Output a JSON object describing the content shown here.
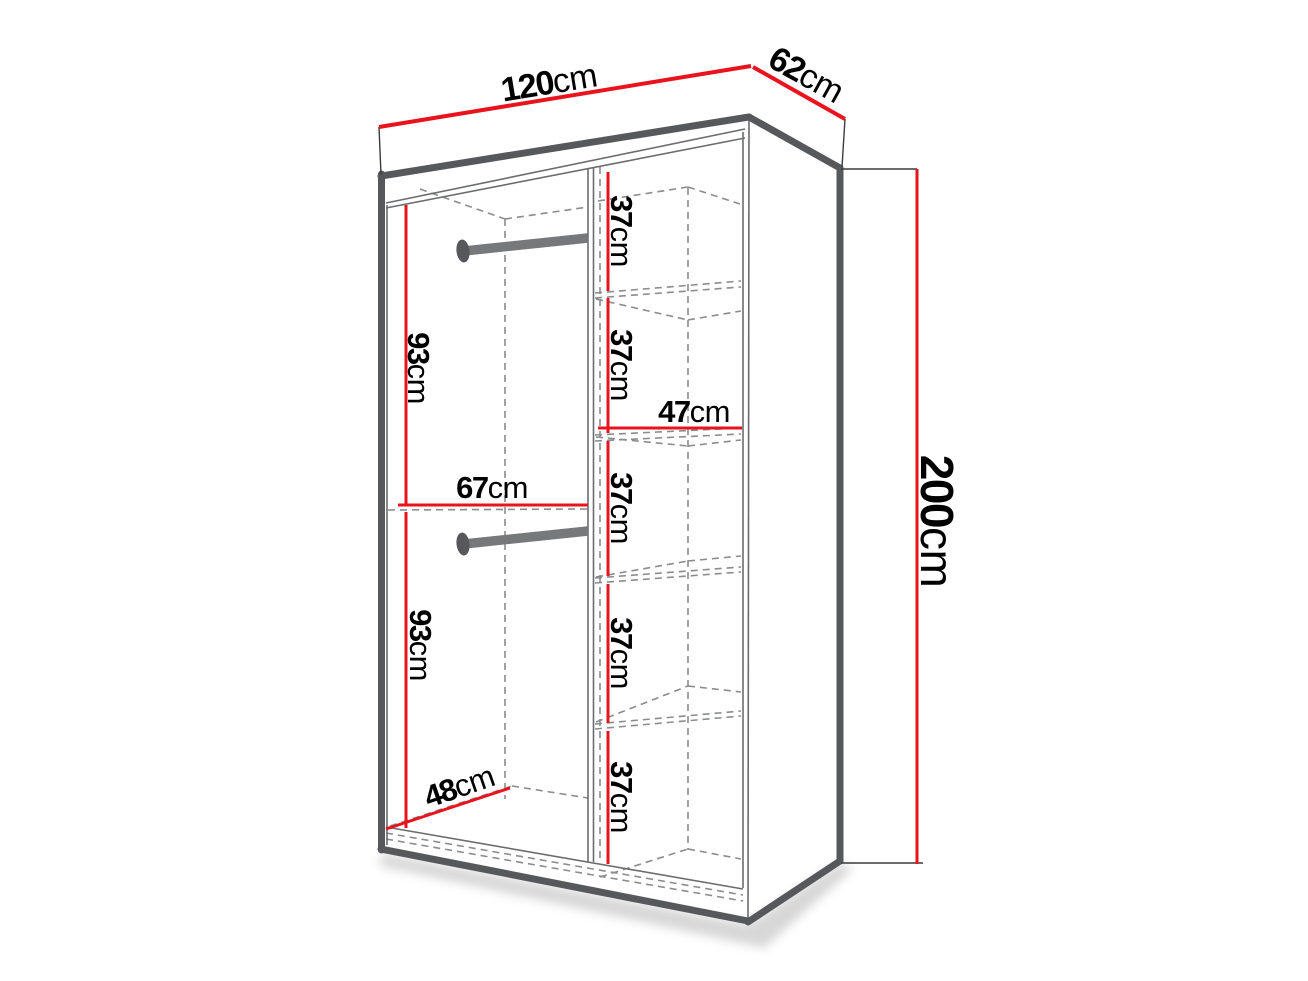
{
  "diagram": {
    "type": "furniture-dimension-diagram",
    "subject": "wardrobe interior dimension drawing",
    "unit": "cm",
    "background": "#ffffff",
    "colors": {
      "dimension_line": "#e8131c",
      "outline_dark": "#57585b",
      "outline_thin": "#6a6c6e",
      "hidden_edge_dashed": "#8a8c8e",
      "label_text": "#000000"
    },
    "dims": {
      "width": {
        "value": "120",
        "unit": "cm"
      },
      "depth": {
        "value": "62",
        "unit": "cm"
      },
      "height": {
        "value": "200",
        "unit": "cm"
      },
      "hanging_top_height": {
        "value": "93",
        "unit": "cm"
      },
      "hanging_bottom_height": {
        "value": "93",
        "unit": "cm"
      },
      "hanging_section_width": {
        "value": "67",
        "unit": "cm"
      },
      "interior_depth": {
        "value": "48",
        "unit": "cm"
      },
      "shelf_section_width": {
        "value": "47",
        "unit": "cm"
      },
      "shelf_heights": [
        {
          "value": "37",
          "unit": "cm"
        },
        {
          "value": "37",
          "unit": "cm"
        },
        {
          "value": "37",
          "unit": "cm"
        },
        {
          "value": "37",
          "unit": "cm"
        },
        {
          "value": "37",
          "unit": "cm"
        }
      ]
    },
    "features": {
      "hanging_rods": 2,
      "shelf_count": 4,
      "sections": 2
    }
  }
}
